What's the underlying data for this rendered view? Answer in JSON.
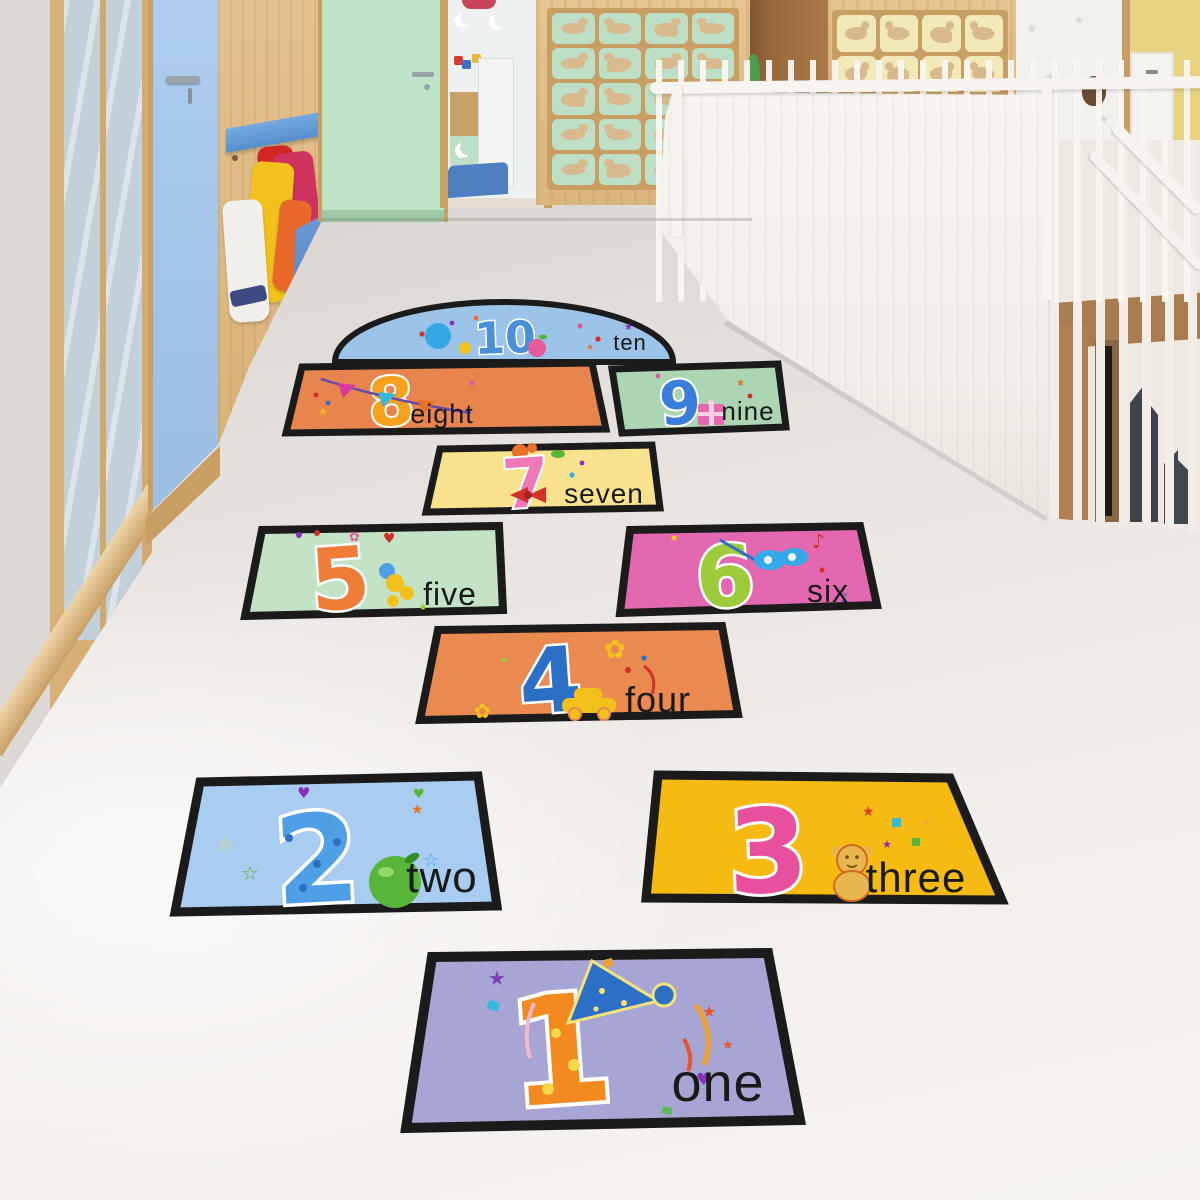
{
  "stickers": {
    "border_color": "#1b1b1b",
    "items": [
      {
        "number": "1",
        "word": "one",
        "tile_color": "#a6a5d3",
        "number_color": "#f28a1f",
        "accent": "party-hat"
      },
      {
        "number": "2",
        "word": "two",
        "tile_color": "#a8cdf0",
        "number_color": "#4f9fe6",
        "accent": "green-apple"
      },
      {
        "number": "3",
        "word": "three",
        "tile_color": "#f5bb13",
        "number_color": "#e84f9c",
        "accent": "teddy-bear"
      },
      {
        "number": "4",
        "word": "four",
        "tile_color": "#ea8a50",
        "number_color": "#2b6fc6",
        "accent": "toy-car"
      },
      {
        "number": "5",
        "word": "five",
        "tile_color": "#c4e3c6",
        "number_color": "#ef7d37",
        "accent": "bow-cluster"
      },
      {
        "number": "6",
        "word": "six",
        "tile_color": "#e468b0",
        "number_color": "#9fca3c",
        "accent": "masquerade-mask"
      },
      {
        "number": "7",
        "word": "seven",
        "tile_color": "#f9e28e",
        "number_color": "#f07ab8",
        "accent": "ribbon-bow"
      },
      {
        "number": "8",
        "word": "eight",
        "tile_color": "#e8854e",
        "number_color": "#f5a31f",
        "accent": "pennant-banner"
      },
      {
        "number": "9",
        "word": "nine",
        "tile_color": "#abd5b3",
        "number_color": "#3a7edb",
        "accent": "gift-box"
      },
      {
        "number": "10",
        "word": "ten",
        "tile_color": "#9cc4e8",
        "number_color": "#4a90d9",
        "accent": "apple"
      }
    ]
  },
  "environment": {
    "floor_color": "#efeae6",
    "wood_color": "#dcb57e",
    "blue_door_color": "#a3c4e8",
    "mint_door_color": "#bfe3c9",
    "left_panel_cell_color": "#bcdfc6",
    "right_panel_cell_color": "#f1eab8",
    "star_wall_color": "#f3f1ed",
    "yellow_wall_color": "#e7d382",
    "railing_color": "#f8f5f1",
    "mosaic_blue": "#2b52a8"
  }
}
